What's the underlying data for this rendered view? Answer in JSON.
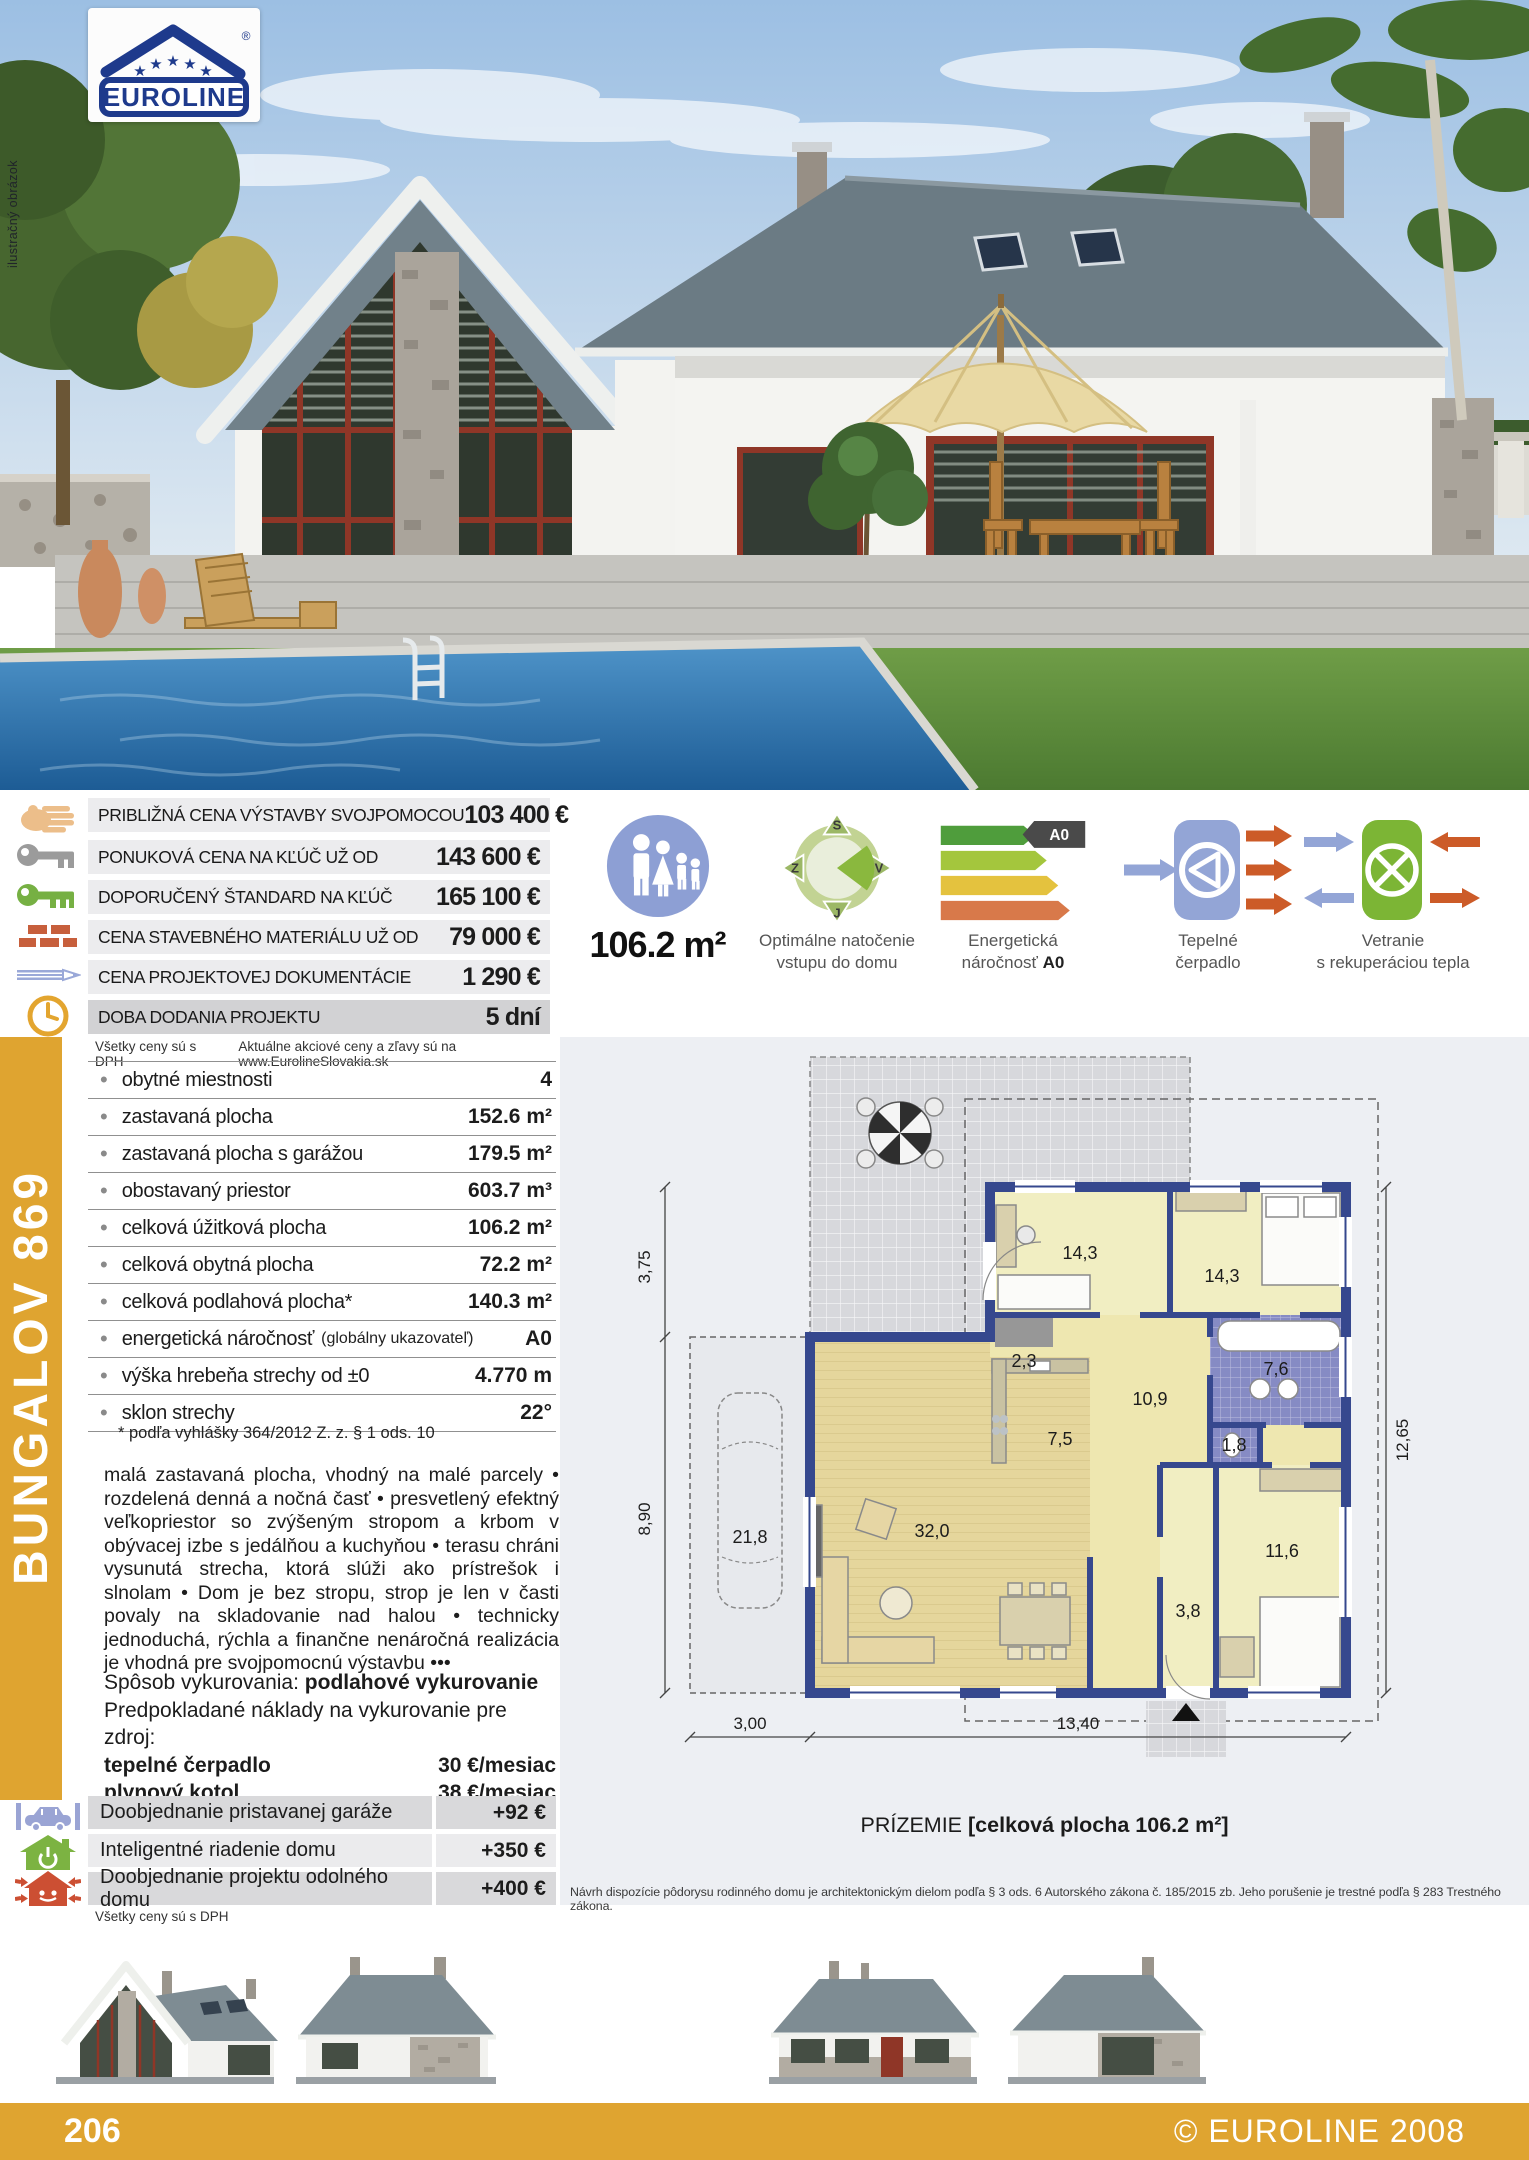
{
  "photo": {
    "watermark": "ilustračný obrázok",
    "logo_text": "EUROLINE",
    "logo_reg": "®"
  },
  "prices": {
    "rows": [
      {
        "label": "PRIBLIŽNÁ CENA VÝSTAVBY SVOJPOMOCOU",
        "value": "103 400 €",
        "icon": "hand-icon"
      },
      {
        "label": "PONUKOVÁ CENA NA KĽÚČ UŽ OD",
        "value": "143 600 €",
        "icon": "key-gray-icon"
      },
      {
        "label": "DOPORUČENÝ ŠTANDARD NA KĽÚČ",
        "value": "165 100 €",
        "icon": "key-green-icon"
      },
      {
        "label": "CENA STAVEBNÉHO MATERIÁLU UŽ OD",
        "value": "79 000 €",
        "icon": "bricks-icon"
      },
      {
        "label": "CENA PROJEKTOVEJ DOKUMENTÁCIE",
        "value": "1 290 €",
        "icon": "pencil-icon"
      },
      {
        "label": "DOBA DODANIA PROJEKTU",
        "value": "5 dní",
        "icon": "clock-icon"
      }
    ],
    "note_left": "Všetky ceny sú s DPH",
    "note_right": "Aktuálne akciové ceny a zľavy sú na www.EurolineSlovakia.sk"
  },
  "features": {
    "area": "106.2 m²",
    "orientation": {
      "line1": "Optimálne natočenie",
      "line2": "vstupu do domu",
      "compass": {
        "n": "S",
        "e": "V",
        "s": "J",
        "w": "Z"
      }
    },
    "energy": {
      "line1": "Energetická",
      "line2": "náročnosť",
      "badge": "A0"
    },
    "heatpump": {
      "line1": "Tepelné",
      "line2": "čerpadlo"
    },
    "ventilation": {
      "line1": "Vetranie",
      "line2": "s rekuperáciou tepla"
    }
  },
  "model": "BUNGALOV 869",
  "specs": {
    "rows": [
      {
        "label": "obytné miestnosti",
        "sub": "",
        "value": "4"
      },
      {
        "label": "zastavaná plocha",
        "sub": "",
        "value": "152.6 m²"
      },
      {
        "label": "zastavaná plocha s garážou",
        "sub": "",
        "value": "179.5 m²"
      },
      {
        "label": "obostavaný priestor",
        "sub": "",
        "value": "603.7 m³"
      },
      {
        "label": "celková úžitková plocha",
        "sub": "",
        "value": "106.2 m²"
      },
      {
        "label": "celková obytná plocha",
        "sub": "",
        "value": "72.2 m²"
      },
      {
        "label": "celková podlahová plocha*",
        "sub": "",
        "value": "140.3 m²"
      },
      {
        "label": "energetická náročnosť",
        "sub": "(globálny ukazovateľ)",
        "value": "A0"
      },
      {
        "label": "výška hrebeňa strechy od ±0",
        "sub": "",
        "value": "4.770 m"
      },
      {
        "label": "sklon strechy",
        "sub": "",
        "value": "22°"
      }
    ],
    "footnote": "* podľa vyhlášky 364/2012 Z. z. § 1 ods. 10"
  },
  "description": "malá zastavaná plocha, vhodný na malé parcely • rozdelená denná a nočná časť • presvetlený efektný veľkopriestor so zvýšeným stropom a krbom v obývacej izbe s jedálňou a kuchyňou • terasu chráni vysunutá strecha, ktorá slúži ako prístrešok i slnolam • Dom je bez stropu, strop je len v časti povaly na skladovanie nad halou • technicky jednoduchá, rýchla a finančne nenáročná realizácia je vhodná pre svojpomocnú výstavbu •••",
  "heating": {
    "prefix": "Spôsob vykurovania:",
    "method": "podlahové vykurovanie",
    "costs_intro": "Predpokladané náklady na vykurovanie pre zdroj:",
    "rows": [
      {
        "label": "tepelné čerpadlo",
        "value": "30 €/mesiac"
      },
      {
        "label": "plynový kotol",
        "value": "38 €/mesiac"
      }
    ]
  },
  "addons": {
    "rows": [
      {
        "label": "Doobjednanie pristavanej garáže",
        "value": "+92 €",
        "icon": "garage-car-icon"
      },
      {
        "label": "Inteligentné riadenie domu",
        "value": "+350 €",
        "icon": "smart-home-icon"
      },
      {
        "label": "Doobjednanie projektu odolného domu",
        "value": "+400 €",
        "icon": "resilient-house-icon"
      }
    ],
    "note": "Všetky ceny sú s DPH"
  },
  "floorplan": {
    "caption_prefix": "PRÍZEMIE",
    "caption_bold": "[celková plocha 106.2 m²]",
    "disclaimer": "Návrh dispozície pôdorysu rodinného domu je architektonickým dielom podľa § 3 ods. 6 Autorského zákona č. 185/2015 zb. Jeho porušenie je trestné podľa § 283 Trestného zákona.",
    "rooms": {
      "r1": "14,3",
      "r2": "14,3",
      "r3": "2,3",
      "r4": "7,6",
      "r5": "7,5",
      "r6": "10,9",
      "r7": "1,8",
      "r8": "32,0",
      "r9": "21,8",
      "r10": "11,6",
      "r11": "3,8"
    },
    "dims": {
      "left_top": "3,75",
      "left_bottom": "8,90",
      "right": "12,65",
      "bottom_left": "3,00",
      "bottom_right": "13,40"
    }
  },
  "footer": {
    "page": "206",
    "copyright": "© EUROLINE 2008"
  },
  "colors": {
    "accent_orange": "#dfa430",
    "wall_blue": "#36488e",
    "energy_green": "#4f9d3c",
    "energy_lime": "#a4c63d",
    "energy_yellow": "#e4c23e",
    "energy_orange": "#d8794a",
    "icon_blue": "#93a5d6",
    "icon_green": "#7cb535",
    "arrow_orange": "#cc5b28"
  }
}
